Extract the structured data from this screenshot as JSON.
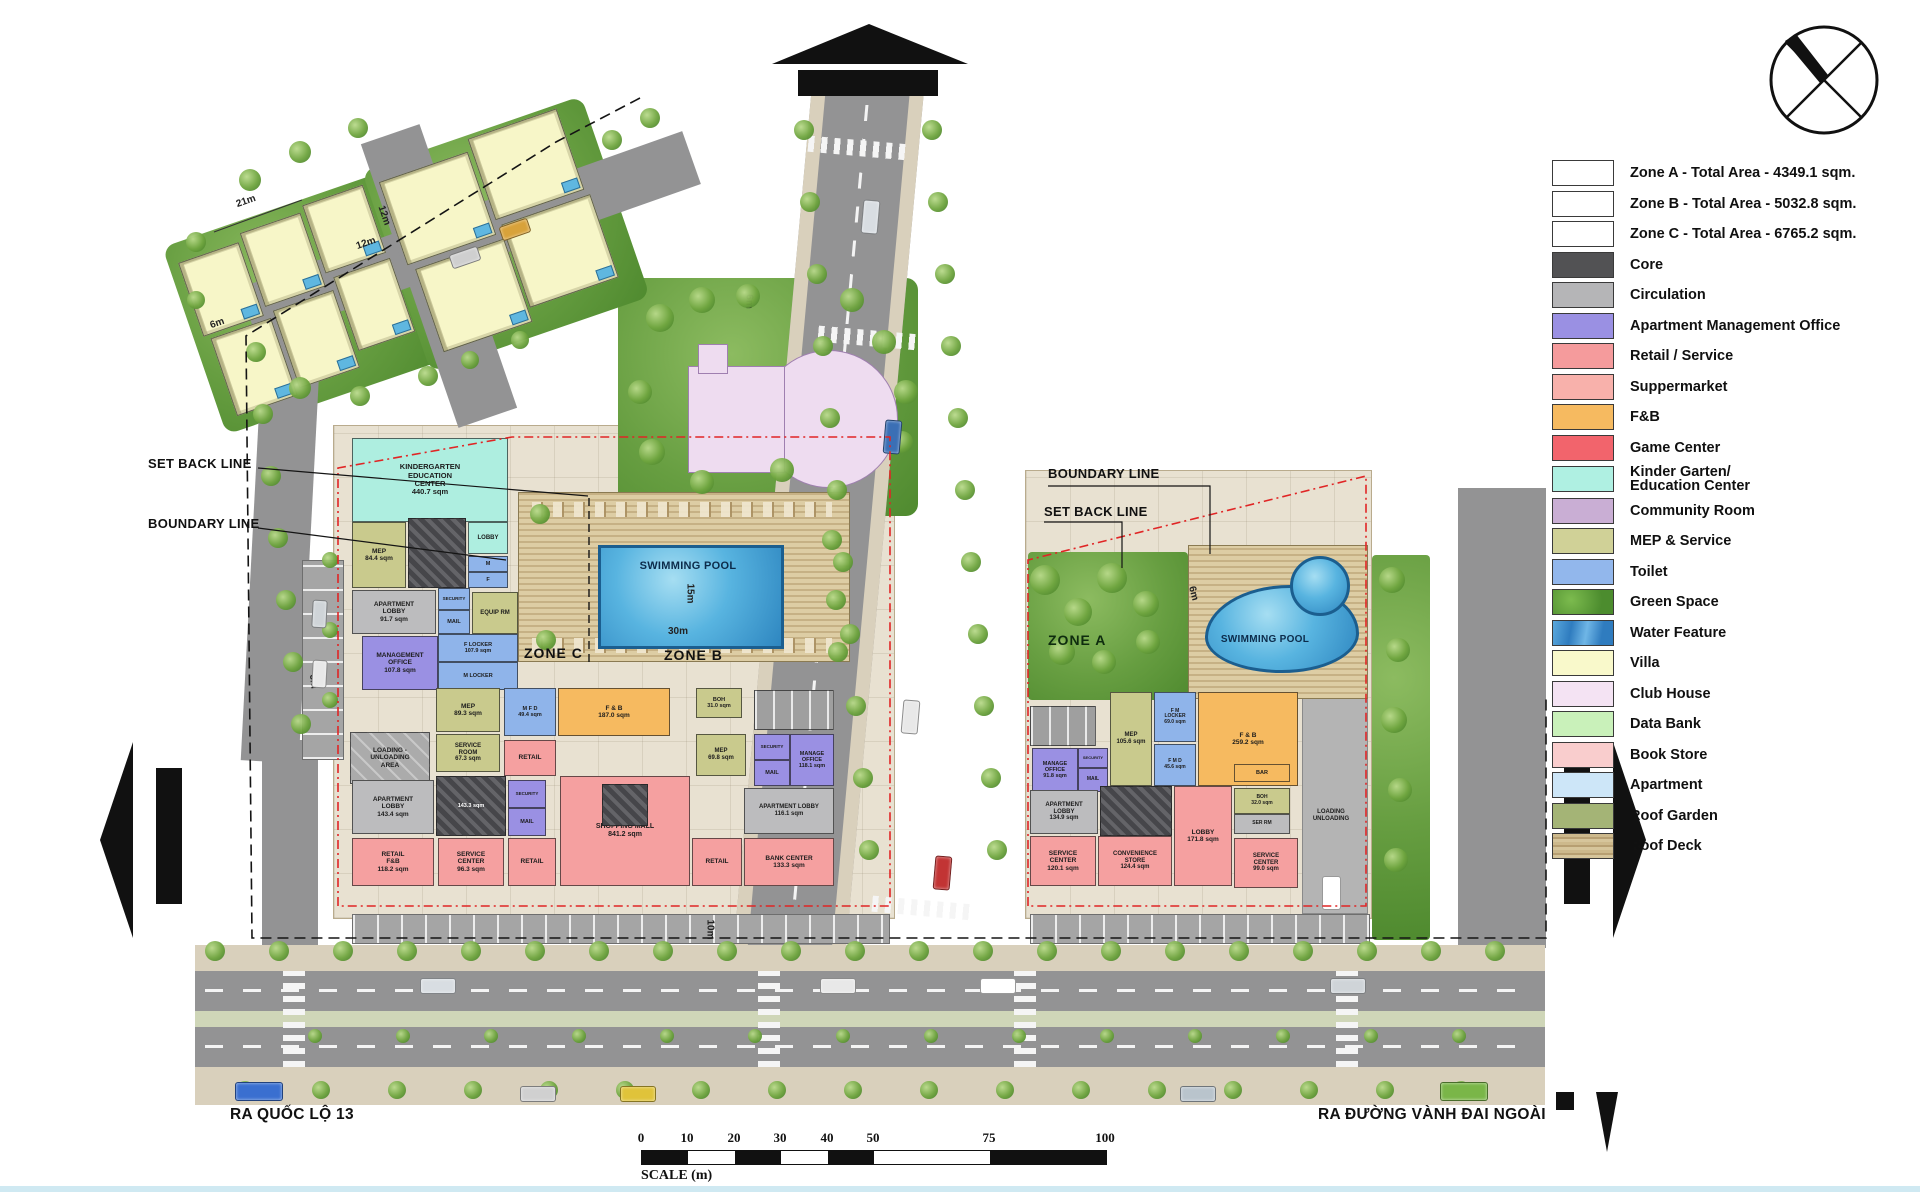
{
  "legend": {
    "items": [
      {
        "id": "zone-a-total",
        "label": "Zone A - Total Area - 4349.1 sqm.",
        "color": "#ffffff",
        "texture": "outline"
      },
      {
        "id": "zone-b-total",
        "label": "Zone B - Total Area - 5032.8 sqm.",
        "color": "#ffffff",
        "texture": "outline"
      },
      {
        "id": "zone-c-total",
        "label": "Zone C - Total Area - 6765.2 sqm.",
        "color": "#ffffff",
        "texture": "outline"
      },
      {
        "id": "core",
        "label": "Core",
        "color": "#525254",
        "texture": "plain"
      },
      {
        "id": "circulation",
        "label": "Circulation",
        "color": "#b5b5b7",
        "texture": "plain"
      },
      {
        "id": "apartment-management-office",
        "label": "Apartment Management Office",
        "color": "#9a90e3",
        "texture": "plain"
      },
      {
        "id": "retail-service",
        "label": "Retail / Service",
        "color": "#f59b9c",
        "texture": "plain"
      },
      {
        "id": "suppermarket",
        "label": "Suppermarket",
        "color": "#f8b1ab",
        "texture": "plain"
      },
      {
        "id": "fnb",
        "label": "F&B",
        "color": "#f6ba60",
        "texture": "plain"
      },
      {
        "id": "game-center",
        "label": "Game Center",
        "color": "#f2646c",
        "texture": "plain"
      },
      {
        "id": "kinder-garten-education-center",
        "label": "Kinder Garten/\nEducation Center",
        "color": "#aff0e2",
        "texture": "plain"
      },
      {
        "id": "community-room",
        "label": "Community Room",
        "color": "#c9aed4",
        "texture": "plain"
      },
      {
        "id": "mep-service",
        "label": "MEP & Service",
        "color": "#d0d197",
        "texture": "plain"
      },
      {
        "id": "toilet",
        "label": "Toilet",
        "color": "#92b7ec",
        "texture": "plain"
      },
      {
        "id": "green-space",
        "label": "Green Space",
        "color": "#5ea33f",
        "texture": "green"
      },
      {
        "id": "water-feature",
        "label": "Water Feature",
        "color": "#3f93d2",
        "texture": "water"
      },
      {
        "id": "villa",
        "label": "Villa",
        "color": "#f9f9cb",
        "texture": "plain"
      },
      {
        "id": "club-house",
        "label": "Club House",
        "color": "#f4e3f3",
        "texture": "plain"
      },
      {
        "id": "data-bank",
        "label": "Data Bank",
        "color": "#c9f1ba",
        "texture": "plain"
      },
      {
        "id": "book-store",
        "label": "Book Store",
        "color": "#f9cdcd",
        "texture": "plain"
      },
      {
        "id": "apartment",
        "label": "Apartment",
        "color": "#cde6f8",
        "texture": "plain"
      },
      {
        "id": "roof-garden",
        "label": "Roof Garden",
        "color": "#a4b476",
        "texture": "plain"
      },
      {
        "id": "roof-deck",
        "label": "Roof Deck",
        "color": "#c9b284",
        "texture": "deck"
      }
    ]
  },
  "annotations": {
    "set_back_line_left": "SET BACK LINE",
    "boundary_line_left": "BOUNDARY LINE",
    "boundary_line_right": "BOUNDARY LINE",
    "set_back_line_right": "SET BACK LINE",
    "zone_a_label": "ZONE A",
    "zone_b_label": "ZONE B",
    "zone_c_label": "ZONE C",
    "pool_left_label": "SWIMMING POOL",
    "pool_right_label": "SWIMMING POOL",
    "street_left": "RA QUỐC LỘ 13",
    "street_right": "RA ĐƯỜNG VÀNH ĐAI NGOÀI"
  },
  "dimensions": [
    {
      "id": "d21",
      "text": "21m"
    },
    {
      "id": "d12a",
      "text": "12m"
    },
    {
      "id": "d12b",
      "text": "12m"
    },
    {
      "id": "d6a",
      "text": "6m"
    },
    {
      "id": "d6b",
      "text": "6m"
    },
    {
      "id": "d6c",
      "text": "6m"
    },
    {
      "id": "d6d",
      "text": "6m"
    },
    {
      "id": "d15",
      "text": "15m"
    },
    {
      "id": "d30",
      "text": "30m"
    },
    {
      "id": "d10",
      "text": "10m"
    }
  ],
  "scale_bar": {
    "ticks": [
      "0",
      "10",
      "20",
      "30",
      "40",
      "50",
      "75",
      "100"
    ],
    "label": "SCALE (m)"
  },
  "plan": {
    "left_rooms": [
      {
        "id": "kinder",
        "type": "kinder",
        "label": "KINDERGARTEN\nEDUCATION\nCENTER\n440.7 sqm"
      },
      {
        "id": "mep1",
        "type": "mep",
        "label": "MEP\n84.4 sqm"
      },
      {
        "id": "core1",
        "type": "core",
        "label": ""
      },
      {
        "id": "lobby1",
        "type": "kinder",
        "label": "LOBBY"
      },
      {
        "id": "wcM1",
        "type": "toilet",
        "label": "M"
      },
      {
        "id": "wcF1",
        "type": "toilet",
        "label": "F"
      },
      {
        "id": "aptlobby1",
        "type": "circ",
        "label": "APARTMENT\nLOBBY\n91.7 sqm"
      },
      {
        "id": "sec1",
        "type": "toilet",
        "label": "SECURITY"
      },
      {
        "id": "mail1",
        "type": "toilet",
        "label": "MAIL"
      },
      {
        "id": "equip1",
        "type": "mep",
        "label": "EQUIP RM"
      },
      {
        "id": "mgmt1",
        "type": "office",
        "label": "MANAGEMENT\nOFFICE\n107.8 sqm"
      },
      {
        "id": "flock1",
        "type": "toilet",
        "label": "F LOCKER\n107.9 sqm"
      },
      {
        "id": "mlock1",
        "type": "toilet",
        "label": "M LOCKER"
      },
      {
        "id": "loading1",
        "type": "loading",
        "label": "LOADING -\nUNLOADING\nAREA"
      },
      {
        "id": "mep2",
        "type": "mep",
        "label": "MEP\n89.3 sqm"
      },
      {
        "id": "serv1",
        "type": "mep",
        "label": "SERVICE\nROOM\n67.3 sqm"
      },
      {
        "id": "wc2",
        "type": "toilet",
        "label": "M F D\n49.4 sqm"
      },
      {
        "id": "fnb1",
        "type": "fnb",
        "label": "F & B\n187.0 sqm"
      },
      {
        "id": "retail1",
        "type": "retail",
        "label": "RETAIL"
      },
      {
        "id": "core2",
        "type": "core",
        "label": "143.3 sqm"
      },
      {
        "id": "aptlobby2",
        "type": "circ",
        "label": "APARTMENT\nLOBBY\n143.4 sqm"
      },
      {
        "id": "sec2",
        "type": "office",
        "label": "SECURITY"
      },
      {
        "id": "mail2",
        "type": "office",
        "label": "MAIL"
      },
      {
        "id": "retailfb1",
        "type": "retail",
        "label": "RETAIL\nF&B\n118.2 sqm"
      },
      {
        "id": "servctr1",
        "type": "retail",
        "label": "SERVICE\nCENTER\n96.3 sqm"
      },
      {
        "id": "retail2",
        "type": "retail",
        "label": "RETAIL"
      },
      {
        "id": "mall",
        "type": "retail",
        "label": "SHOPPING MALL\n841.2 sqm"
      },
      {
        "id": "core2b",
        "type": "core",
        "label": ""
      },
      {
        "id": "boh1",
        "type": "mep",
        "label": "BOH\n31.0 sqm"
      },
      {
        "id": "mep3",
        "type": "mep",
        "label": "MEP\n69.8 sqm"
      },
      {
        "id": "park1",
        "type": "park",
        "label": ""
      },
      {
        "id": "sec3",
        "type": "office",
        "label": "SECURITY"
      },
      {
        "id": "mgof1",
        "type": "office",
        "label": "MANAGE\nOFFICE\n118.1 sqm"
      },
      {
        "id": "mail3",
        "type": "office",
        "label": "MAIL"
      },
      {
        "id": "aptlobby3",
        "type": "circ",
        "label": "APARTMENT LOBBY\n116.1 sqm"
      },
      {
        "id": "retail3",
        "type": "retail",
        "label": "RETAIL"
      },
      {
        "id": "bank1",
        "type": "retail",
        "label": "BANK CENTER\n133.3 sqm"
      }
    ],
    "right_rooms": [
      {
        "id": "park2",
        "type": "park",
        "label": ""
      },
      {
        "id": "mgof2",
        "type": "office",
        "label": "MANAGE\nOFFICE\n91.8 sqm"
      },
      {
        "id": "sec4",
        "type": "office",
        "label": "SECURITY"
      },
      {
        "id": "mail4",
        "type": "office",
        "label": "MAIL"
      },
      {
        "id": "mep4",
        "type": "mep",
        "label": "MEP\n105.6 sqm"
      },
      {
        "id": "lock1",
        "type": "toilet",
        "label": "F M\nLOCKER\n69.0 sqm"
      },
      {
        "id": "wc3",
        "type": "toilet",
        "label": "F M D\n45.6 sqm"
      },
      {
        "id": "fnb2",
        "type": "fnb",
        "label": "F & B\n259.2 sqm"
      },
      {
        "id": "bar1",
        "type": "fnb",
        "label": "BAR"
      },
      {
        "id": "aptlobby4",
        "type": "circ",
        "label": "APARTMENT\nLOBBY\n134.9 sqm"
      },
      {
        "id": "core3",
        "type": "core",
        "label": ""
      },
      {
        "id": "lobby2",
        "type": "retail",
        "label": "LOBBY\n171.8 sqm"
      },
      {
        "id": "boh2",
        "type": "mep",
        "label": "BOH\n32.0 sqm"
      },
      {
        "id": "serrm1",
        "type": "circ",
        "label": "SER RM"
      },
      {
        "id": "servctr2",
        "type": "retail",
        "label": "SERVICE\nCENTER\n120.1 sqm"
      },
      {
        "id": "conv1",
        "type": "retail",
        "label": "CONVENIENCE\nSTORE\n124.4 sqm"
      },
      {
        "id": "servctr3",
        "type": "retail",
        "label": "SERVICE\nCENTER\n99.0 sqm"
      },
      {
        "id": "loadlbl",
        "type": "none",
        "label": "LOADING\nUNLOADING"
      }
    ]
  }
}
